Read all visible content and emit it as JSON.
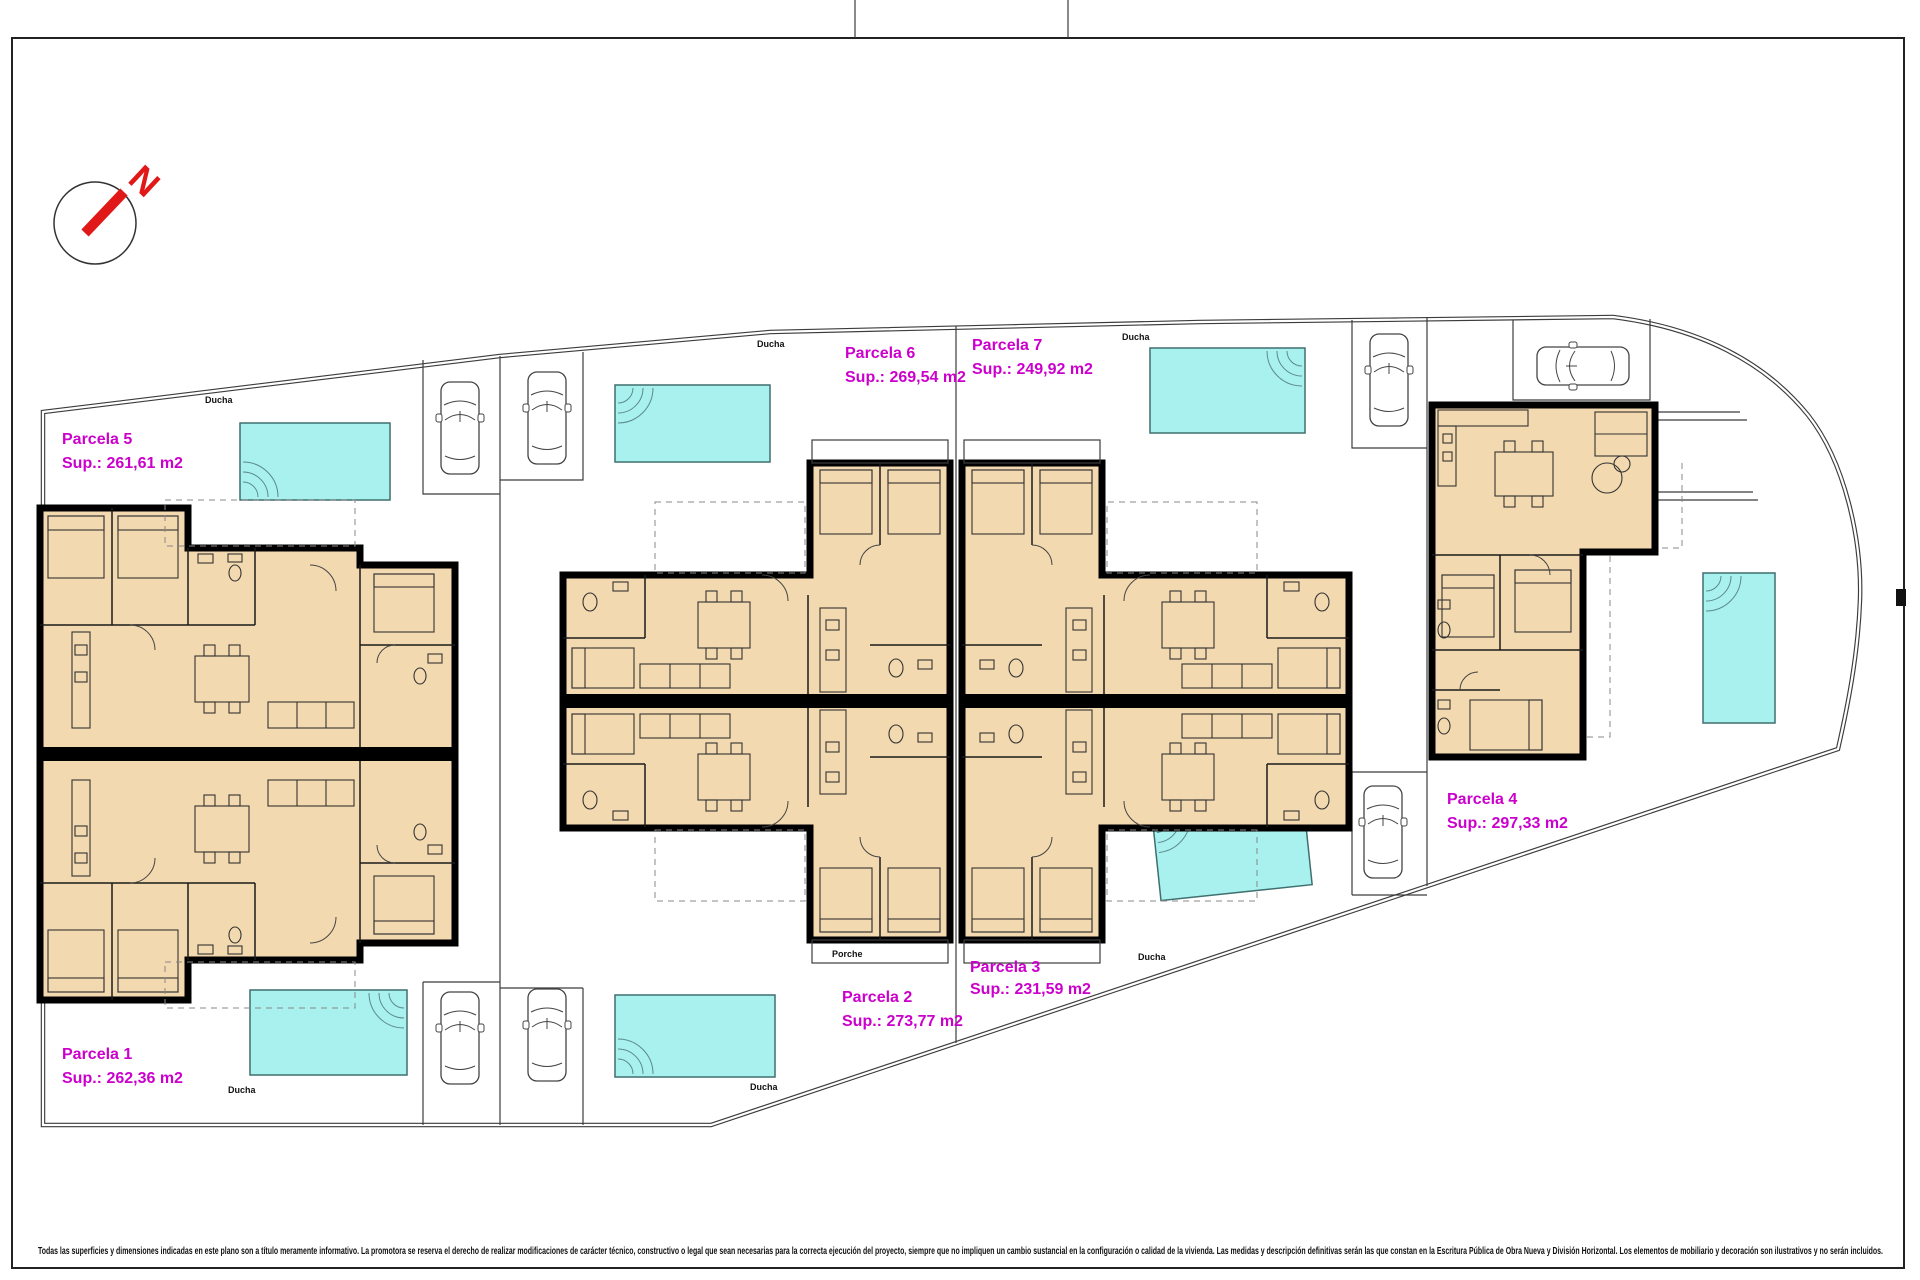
{
  "page": {
    "type": "architectural site plan",
    "frame_color": "#222222"
  },
  "north_arrow": {
    "label": "N",
    "color": "#e01818"
  },
  "colors": {
    "parcel_label": "#cc00cc",
    "pool_fill": "#a9f1ee",
    "pool_border": "#3f6f6f",
    "room_fill": "#f3d9af",
    "wall": "#000000"
  },
  "parcels": [
    {
      "name": "Parcela 5",
      "area": "Sup.: 261,61 m2"
    },
    {
      "name": "Parcela 1",
      "area": "Sup.: 262,36 m2"
    },
    {
      "name": "Parcela 6",
      "area": "Sup.: 269,54 m2"
    },
    {
      "name": "Parcela 7",
      "area": "Sup.: 249,92 m2"
    },
    {
      "name": "Parcela 2",
      "area": "Sup.: 273,77 m2"
    },
    {
      "name": "Parcela 3",
      "area": "Sup.: 231,59 m2"
    },
    {
      "name": "Parcela 4",
      "area": "Sup.: 297,33 m2"
    }
  ],
  "annotations": {
    "ducha": "Ducha",
    "porche": "Porche"
  },
  "footer": {
    "disclaimer": "Todas las superficies y dimensiones indicadas en este plano son a título meramente informativo. La promotora se reserva el derecho de realizar modificaciones de carácter técnico, constructivo o legal que sean necesarias para la correcta ejecución del proyecto, siempre que no impliquen un cambio sustancial en la configuración o calidad de la vivienda. Las medidas y descripción definitivas serán las que constan en la Escritura Pública de Obra Nueva y División Horizontal. Los elementos de mobiliario y decoración son ilustrativos y no serán incluidos."
  }
}
